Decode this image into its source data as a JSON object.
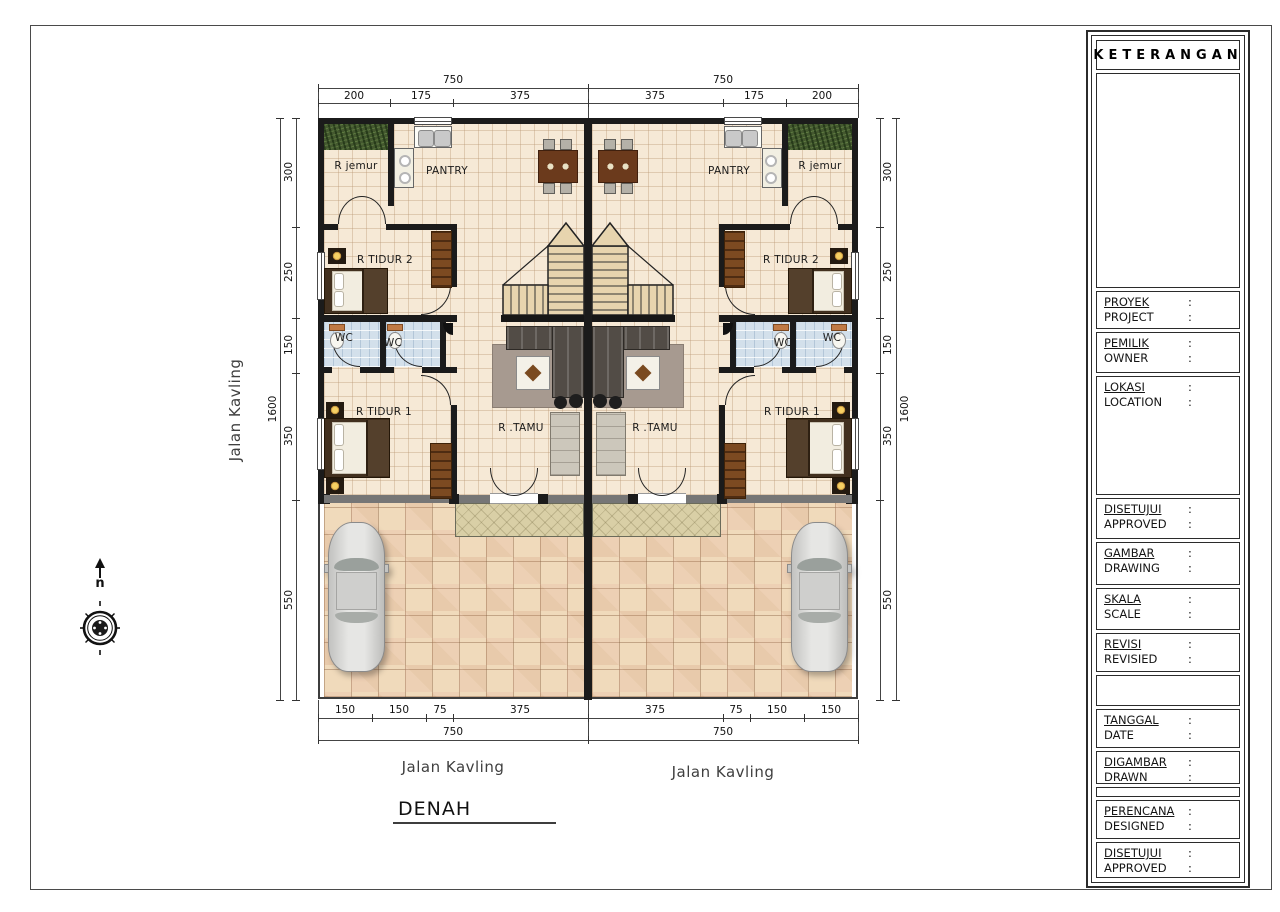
{
  "colors": {
    "wall": "#1b1b1b",
    "floor": "#f6e9d6",
    "yard_tile": "#f0dabb",
    "grass": "#44582f",
    "wc_floor": "#d3e0eb",
    "stairs": "#e7d4ae",
    "porch": "#d9cfa6",
    "dim_line": "#444444"
  },
  "title_block": {
    "header": "KETERANGAN",
    "colon": ":",
    "rows": [
      {
        "label": "PROYEK",
        "label_en": "PROJECT"
      },
      {
        "label": "PEMILIK",
        "label_en": "OWNER"
      },
      {
        "label": "LOKASI",
        "label_en": "LOCATION"
      },
      {
        "label": "DISETUJUI",
        "label_en": "APPROVED"
      },
      {
        "label": "GAMBAR",
        "label_en": "DRAWING"
      },
      {
        "label": "SKALA",
        "label_en": "SCALE"
      },
      {
        "label": "REVISI",
        "label_en": "REVISIED"
      },
      {
        "label": "TANGGAL",
        "label_en": "DATE"
      },
      {
        "label": "DIGAMBAR",
        "label_en": "DRAWN"
      },
      {
        "label": "PERENCANA",
        "label_en": "DESIGNED"
      },
      {
        "label": "DISETUJUI",
        "label_en": "APPROVED"
      }
    ]
  },
  "plan": {
    "title": "DENAH",
    "north_label": "n",
    "street_left": "Jalan Kavling",
    "street_bottom_left": "Jalan Kavling",
    "street_bottom_right": "Jalan Kavling",
    "rooms": {
      "r_jemur": "R jemur",
      "pantry": "PANTRY",
      "r_tidur_2": "R TIDUR 2",
      "wc": "WC",
      "r_tidur_1": "R TIDUR 1",
      "r_tamu": "R .TAMU"
    }
  },
  "dimensions": {
    "top_totals": [
      "750",
      "750"
    ],
    "top_segments": [
      "200",
      "175",
      "375",
      "375",
      "175",
      "200"
    ],
    "left_total": "1600",
    "left_segments": [
      "300",
      "250",
      "150",
      "350",
      "550"
    ],
    "right_total": "1600",
    "right_segments": [
      "300",
      "250",
      "150",
      "350",
      "550"
    ],
    "bottom_segments": [
      "150",
      "150",
      "75",
      "375",
      "375",
      "75",
      "150",
      "150"
    ],
    "bottom_totals": [
      "750",
      "750"
    ]
  }
}
